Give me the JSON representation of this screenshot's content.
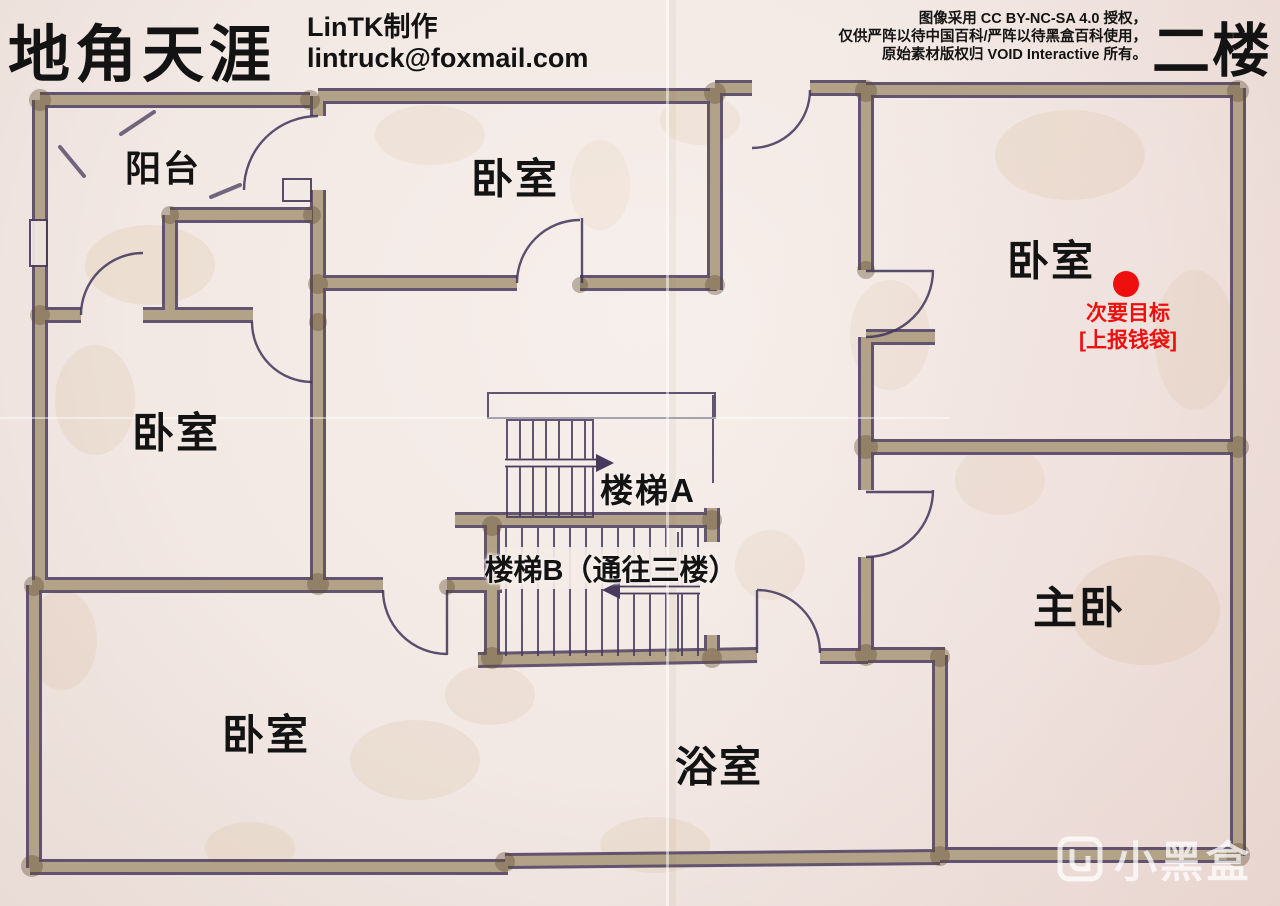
{
  "header": {
    "title": "地角天涯",
    "author": "LinTK制作",
    "email": "lintruck@foxmail.com",
    "license_lines": [
      "图像采用 CC BY-NC-SA 4.0 授权，",
      "仅供严阵以待中国百科/严阵以待黑盒百科使用，",
      "原始素材版权归 VOID Interactive 所有。"
    ],
    "floor": "二楼"
  },
  "plan": {
    "rooms": [
      {
        "id": "balcony",
        "label": "阳台"
      },
      {
        "id": "bedroom-top",
        "label": "卧室"
      },
      {
        "id": "bedroom-top-right",
        "label": "卧室"
      },
      {
        "id": "bedroom-left",
        "label": "卧室"
      },
      {
        "id": "bedroom-bottom-left",
        "label": "卧室"
      },
      {
        "id": "master-bedroom",
        "label": "主卧"
      },
      {
        "id": "bathroom",
        "label": "浴室"
      },
      {
        "id": "stairs-a",
        "label": "楼梯A"
      },
      {
        "id": "stairs-b",
        "label": "楼梯B（通往三楼）"
      }
    ],
    "objective": {
      "type_label": "次要目标",
      "detail_label": "[上报钱袋]",
      "marker_color": "#ee100f"
    }
  },
  "watermark": {
    "text": "小黑盒"
  },
  "colors": {
    "paper": "#f2e8e4",
    "wall_fill": "#b2a287",
    "ink": "#4a3b5c",
    "text": "#131313",
    "objective_red": "#ee100f"
  }
}
